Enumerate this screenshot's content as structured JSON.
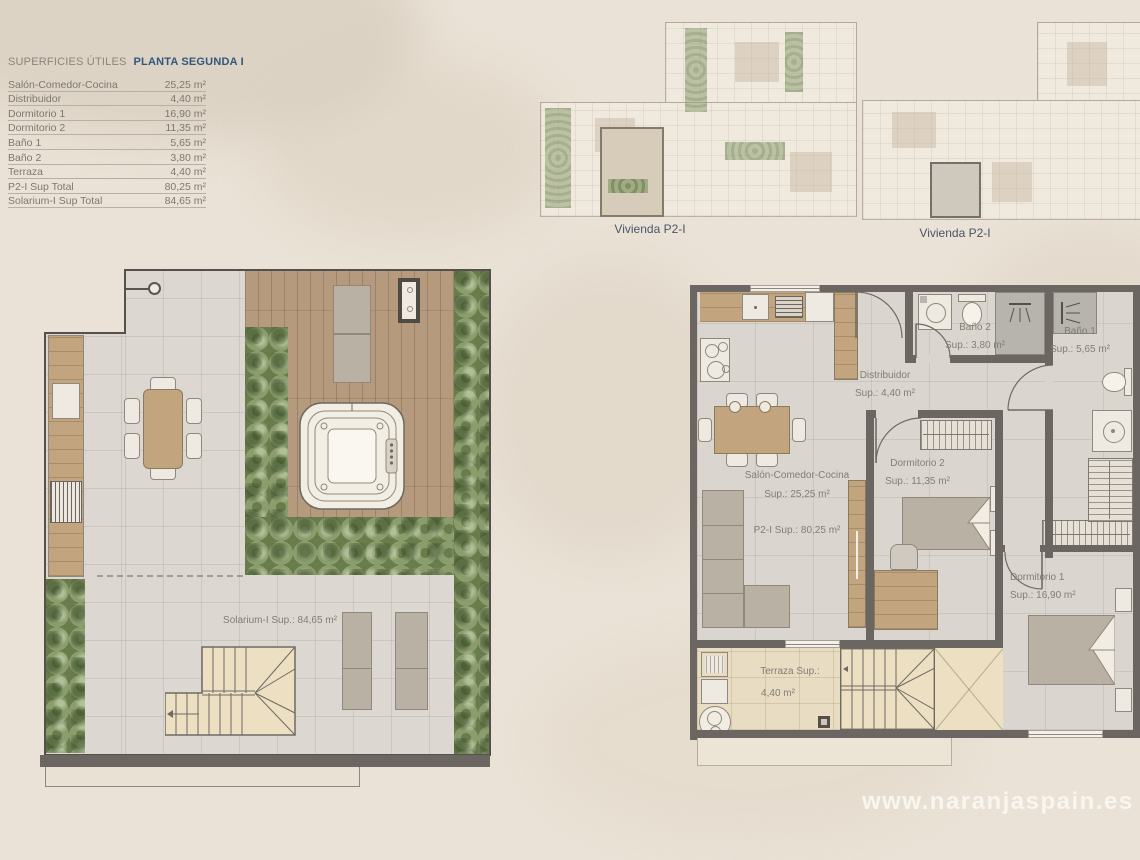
{
  "page": {
    "watermark": "www.naranjaspain.es"
  },
  "colors": {
    "background": "#eae2d6",
    "accent_navy": "#33567d",
    "text_grey": "#7d786f",
    "wall_dark": "#6b6662",
    "wood": "#b69a7d",
    "plant_green": "#7f915f",
    "tile_grey": "#dcd8d1",
    "terrace_beige": "#e8dcc2",
    "caption_slate": "#4b5568"
  },
  "table": {
    "title_left": "SUPERFICIES ÚTILES",
    "title_right": "PLANTA SEGUNDA I",
    "rows": [
      {
        "label": "Salón-Comedor-Cocina",
        "value": "25,25 m²"
      },
      {
        "label": "Distribuidor",
        "value": "4,40 m²"
      },
      {
        "label": "Dormitorio 1",
        "value": "16,90 m²"
      },
      {
        "label": "Dormitorio 2",
        "value": "11,35 m²"
      },
      {
        "label": "Baño 1",
        "value": "5,65 m²"
      },
      {
        "label": "Baño 2",
        "value": "3,80 m²"
      },
      {
        "label": "Terraza",
        "value": "4,40 m²"
      },
      {
        "label": "P2-I Sup Total",
        "value": "80,25 m²"
      },
      {
        "label": "Solarium-I Sup Total",
        "value": "84,65 m²"
      }
    ]
  },
  "overviews": {
    "caption_left": "Vivienda P2-I",
    "caption_right": "Vivienda P2-I"
  },
  "solarium_plan": {
    "area_label": "Solarium-I Sup.: 84,65 m²"
  },
  "apartment_plan": {
    "salon": {
      "name": "Salón-Comedor-Cocina",
      "sup": "Sup.: 25,25 m²",
      "total_sup": "P2-I Sup.: 80,25 m²"
    },
    "distribuidor": {
      "name": "Distribuidor",
      "sup": "Sup.: 4,40 m²"
    },
    "dormitorio1": {
      "name": "Dormitorio 1",
      "sup": "Sup.: 16,90 m²"
    },
    "dormitorio2": {
      "name": "Dormitorio 2",
      "sup": "Sup.: 11,35 m²"
    },
    "banio1": {
      "name": "Baño 1",
      "sup": "Sup.: 5,65 m²"
    },
    "banio2": {
      "name": "Baño 2",
      "sup": "Sup.: 3,80 m²"
    },
    "terraza": {
      "name": "Terraza Sup.:",
      "sup": "4,40 m²"
    }
  }
}
